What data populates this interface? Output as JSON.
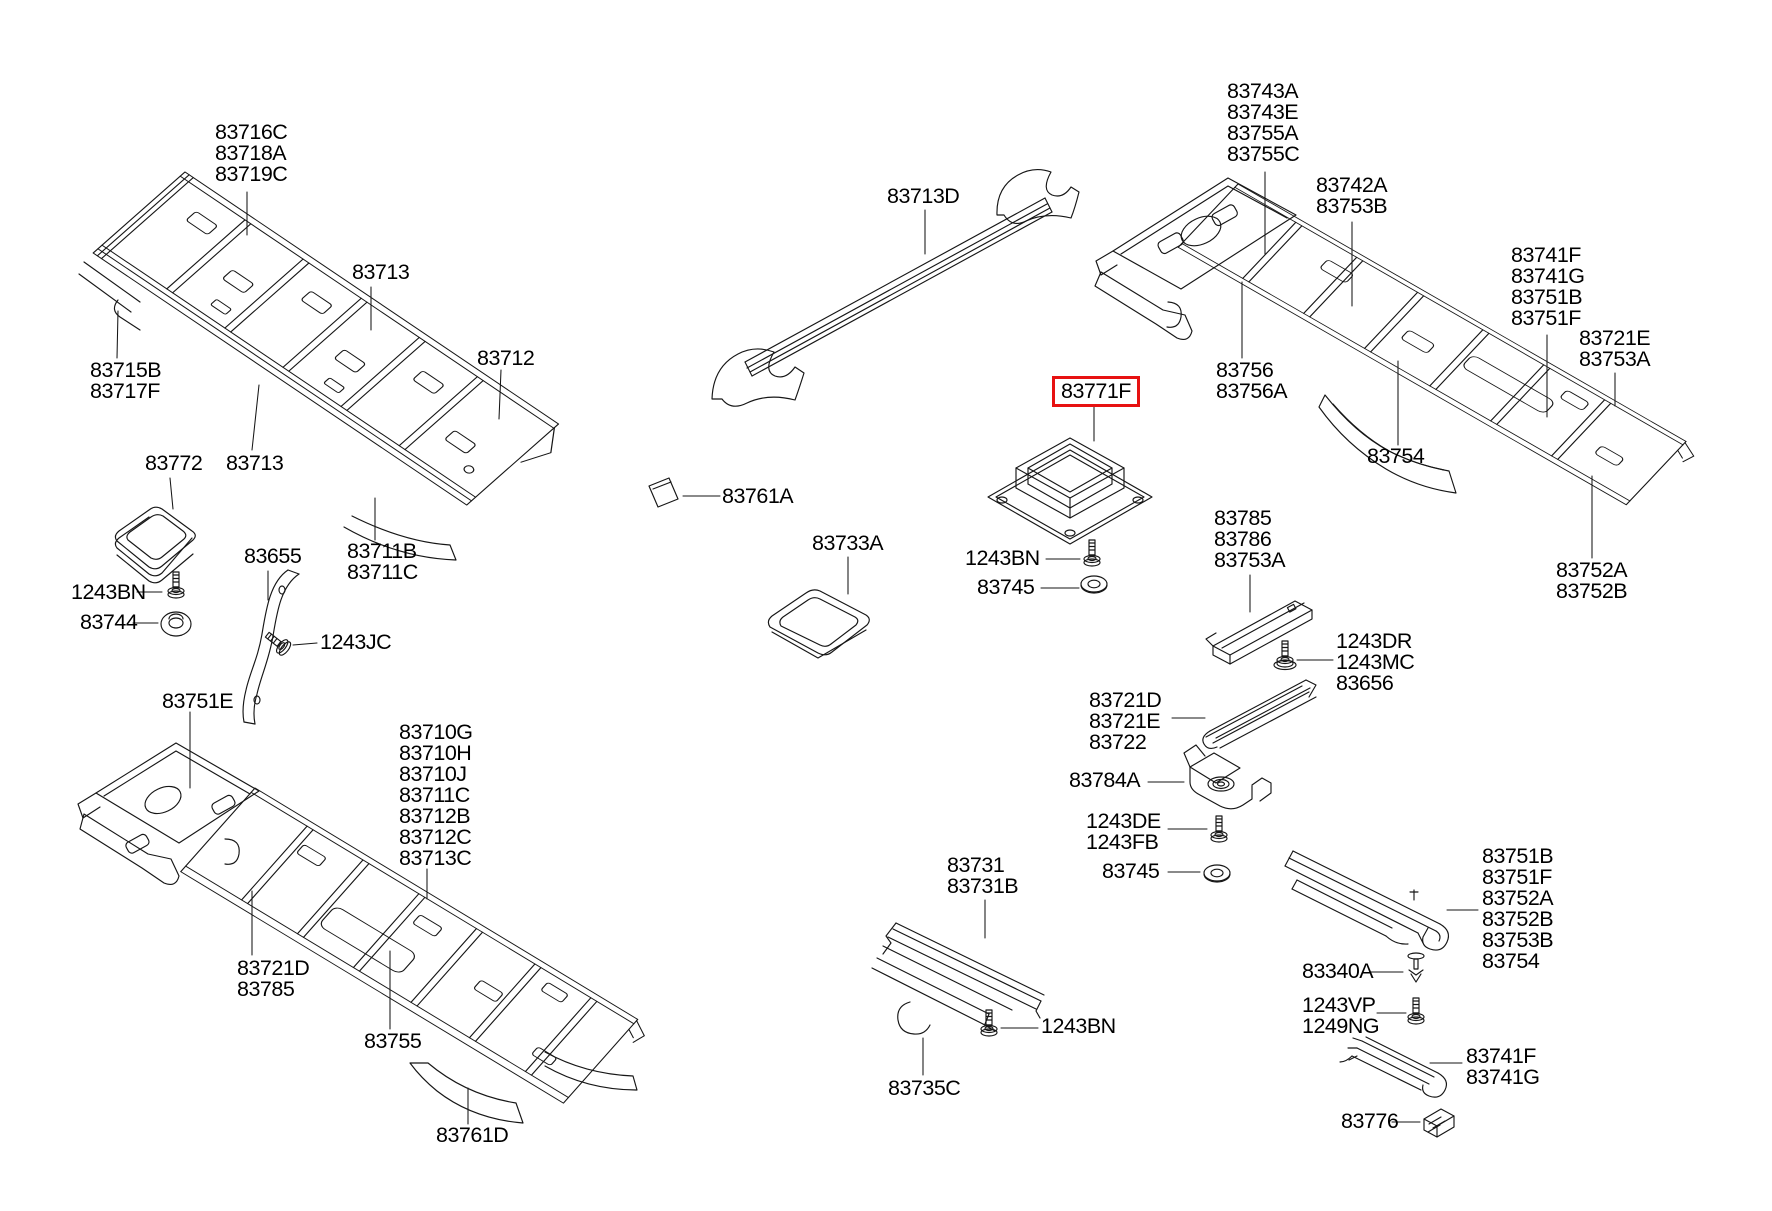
{
  "diagram": {
    "title": "Roof trim / headlining parts diagram",
    "background": "#ffffff",
    "line_color": "#161616",
    "text_color": "#000000",
    "highlight": {
      "part": "83771F",
      "box_color": "#e71111"
    }
  },
  "callouts": [
    {
      "id": "83716C-83718A-83719C",
      "text": "83716C\n83718A\n83719C",
      "x": 215,
      "y": 122
    },
    {
      "id": "83713-upper",
      "text": "83713",
      "x": 352,
      "y": 262
    },
    {
      "id": "83715B-83717F",
      "text": "83715B\n83717F",
      "x": 90,
      "y": 360
    },
    {
      "id": "83712",
      "text": "83712",
      "x": 477,
      "y": 348
    },
    {
      "id": "83772",
      "text": "83772",
      "x": 145,
      "y": 453
    },
    {
      "id": "83713-lower",
      "text": "83713",
      "x": 226,
      "y": 453
    },
    {
      "id": "83711B-83711C",
      "text": "83711B\n83711C",
      "x": 347,
      "y": 541
    },
    {
      "id": "83761A",
      "text": "83761A",
      "x": 722,
      "y": 486
    },
    {
      "id": "1243BN-left",
      "text": "1243BN",
      "x": 71,
      "y": 582
    },
    {
      "id": "83744",
      "text": "83744",
      "x": 80,
      "y": 612
    },
    {
      "id": "83655",
      "text": "83655",
      "x": 244,
      "y": 546
    },
    {
      "id": "1243JC",
      "text": "1243JC",
      "x": 320,
      "y": 632
    },
    {
      "id": "83751E",
      "text": "83751E",
      "x": 162,
      "y": 691
    },
    {
      "id": "83710G-group",
      "text": "83710G\n83710H\n83710J\n83711C\n83712B\n83712C\n83713C",
      "x": 399,
      "y": 722
    },
    {
      "id": "83721D-83785",
      "text": "83721D\n83785",
      "x": 237,
      "y": 958
    },
    {
      "id": "83755",
      "text": "83755",
      "x": 364,
      "y": 1031
    },
    {
      "id": "83761D",
      "text": "83761D",
      "x": 436,
      "y": 1125
    },
    {
      "id": "83713D",
      "text": "83713D",
      "x": 887,
      "y": 186
    },
    {
      "id": "83733A",
      "text": "83733A",
      "x": 812,
      "y": 533
    },
    {
      "id": "83771F",
      "text": "83771F",
      "x": 1052,
      "y": 376,
      "boxed": true
    },
    {
      "id": "1243BN-center",
      "text": "1243BN",
      "x": 965,
      "y": 548
    },
    {
      "id": "83745-center",
      "text": "83745",
      "x": 977,
      "y": 577
    },
    {
      "id": "83743A-group",
      "text": "83743A\n83743E\n83755A\n83755C",
      "x": 1227,
      "y": 81
    },
    {
      "id": "83742A-83753B",
      "text": "83742A\n83753B",
      "x": 1316,
      "y": 175
    },
    {
      "id": "83741F-group-top",
      "text": "83741F\n83741G\n83751B\n83751F",
      "x": 1511,
      "y": 245
    },
    {
      "id": "83721E-83753A",
      "text": "83721E\n83753A",
      "x": 1579,
      "y": 328
    },
    {
      "id": "83756-83756A",
      "text": "83756\n83756A",
      "x": 1216,
      "y": 360
    },
    {
      "id": "83754-top",
      "text": "83754",
      "x": 1367,
      "y": 446
    },
    {
      "id": "83752A-83752B",
      "text": "83752A\n83752B",
      "x": 1556,
      "y": 560
    },
    {
      "id": "83785-83786-83753A",
      "text": "83785\n83786\n83753A",
      "x": 1214,
      "y": 508
    },
    {
      "id": "1243DR-1243MC-83656",
      "text": "1243DR\n1243MC\n83656",
      "x": 1336,
      "y": 631
    },
    {
      "id": "83721D-83721E-83722",
      "text": "83721D\n83721E\n83722",
      "x": 1089,
      "y": 690
    },
    {
      "id": "83784A",
      "text": "83784A",
      "x": 1069,
      "y": 770
    },
    {
      "id": "1243DE-1243FB",
      "text": "1243DE\n1243FB",
      "x": 1086,
      "y": 811
    },
    {
      "id": "83745-lower",
      "text": "83745",
      "x": 1102,
      "y": 861
    },
    {
      "id": "83731-83731B",
      "text": "83731\n83731B",
      "x": 947,
      "y": 855
    },
    {
      "id": "1243BN-bottom",
      "text": "1243BN",
      "x": 1041,
      "y": 1016
    },
    {
      "id": "83735C",
      "text": "83735C",
      "x": 888,
      "y": 1078
    },
    {
      "id": "83751B-group-bottom",
      "text": "83751B\n83751F\n83752A\n83752B\n83753B\n83754",
      "x": 1482,
      "y": 846
    },
    {
      "id": "83340A",
      "text": "83340A",
      "x": 1302,
      "y": 961
    },
    {
      "id": "1243VP-1249NG",
      "text": "1243VP\n1249NG",
      "x": 1302,
      "y": 995
    },
    {
      "id": "83741F-83741G-bottom",
      "text": "83741F\n83741G",
      "x": 1466,
      "y": 1046
    },
    {
      "id": "83776",
      "text": "83776",
      "x": 1341,
      "y": 1111
    }
  ]
}
